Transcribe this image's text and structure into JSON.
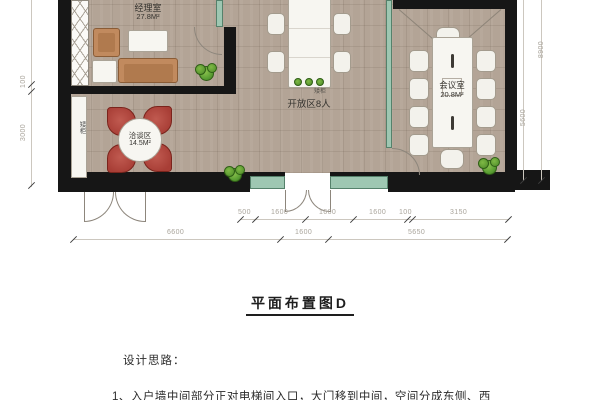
{
  "plan": {
    "rooms": {
      "manager": {
        "name": "经理室",
        "area": "27.8M²"
      },
      "negotiation": {
        "name": "洽谈区",
        "area": "14.5M²"
      },
      "open": {
        "name": "开放区8人"
      },
      "meeting": {
        "name": "会议室",
        "area": "20.8M²"
      }
    },
    "labels": {
      "cabinet_side": "矮柜",
      "cabinet_center": "矮柜"
    },
    "dims": {
      "row1": [
        "500",
        "1600",
        "1600",
        "1600",
        "100",
        "3150"
      ],
      "row2": [
        "6600",
        "1600",
        "5650"
      ],
      "right_outer": "8900",
      "right_inner": "5600",
      "left": [
        "100",
        "3000"
      ]
    }
  },
  "title": "平面布置图D",
  "notes": {
    "heading": "设计思路：",
    "item1": "1、入户墙中间部分正对电梯间入口，大门移到中间，空间分成东侧、西"
  },
  "colors": {
    "wall": "#161616",
    "glass": "#9ec7b2",
    "floor": "#b3a496",
    "red_chair": "#b2483f",
    "wood": "#c18a5e",
    "plant_green": "#5a9e33",
    "dim_text": "#a9a49b"
  }
}
